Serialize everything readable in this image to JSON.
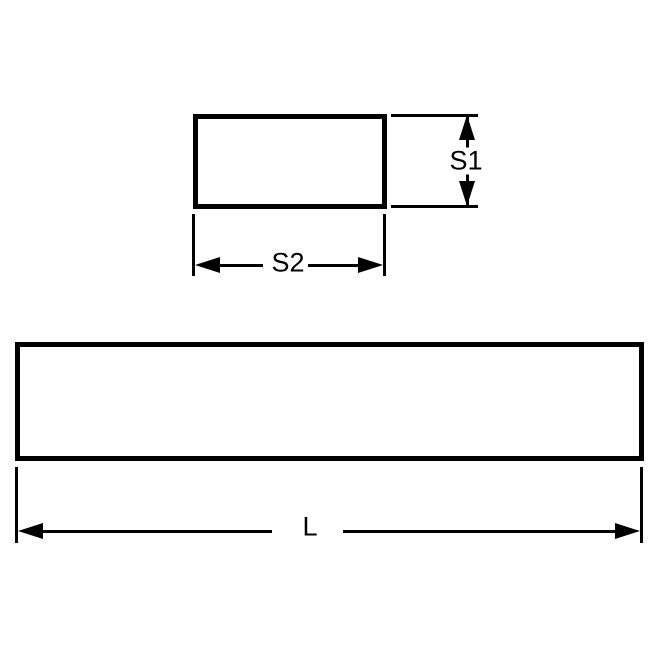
{
  "drawing": {
    "background_color": "#ffffff",
    "stroke_color": "#000000",
    "views": [
      {
        "name": "end-cross-section-view",
        "shape": "rectangle",
        "dimensions": [
          {
            "label": "S1",
            "orientation": "vertical"
          },
          {
            "label": "S2",
            "orientation": "horizontal"
          }
        ]
      },
      {
        "name": "side-view",
        "shape": "rectangle",
        "dimensions": [
          {
            "label": "L",
            "orientation": "horizontal"
          }
        ]
      }
    ]
  }
}
